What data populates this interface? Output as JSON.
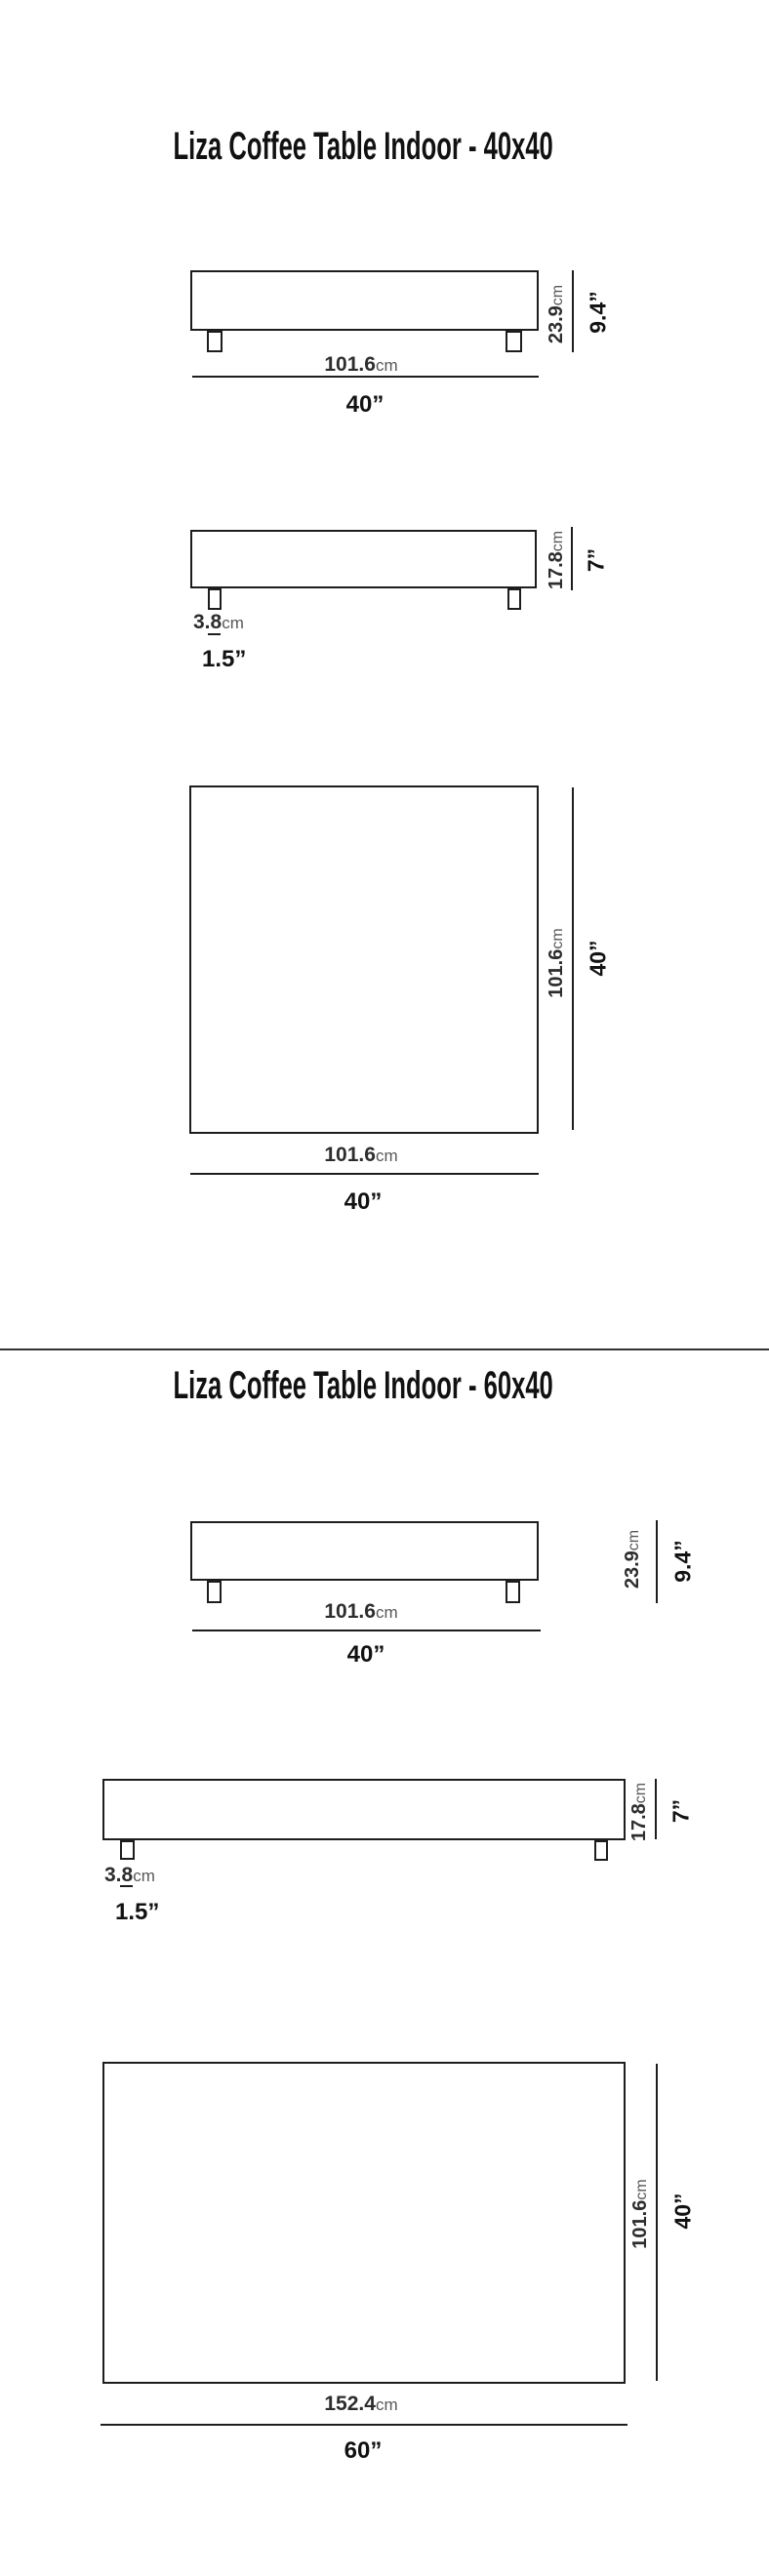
{
  "colors": {
    "background": "#ffffff",
    "line": "#1d1d1d",
    "number_text": "#2d2d2d",
    "cm_unit_text": "#575757",
    "inch_text": "#121212",
    "title_text": "#111111",
    "divider": "#333333"
  },
  "units": {
    "cm": "cm"
  },
  "sections": [
    {
      "title": "Liza Coffee Table Indoor - 40x40",
      "front_view": {
        "total_height_cm": "23.9",
        "total_height_in": "9.4”",
        "width_cm": "101.6",
        "width_in": "40”"
      },
      "profile_view": {
        "body_height_cm": "17.8",
        "body_height_in": "7”",
        "leg_width_cm": "3.8",
        "leg_width_in": "1.5”"
      },
      "top_view": {
        "depth_cm": "101.6",
        "depth_in": "40”",
        "width_cm": "101.6",
        "width_in": "40”"
      }
    },
    {
      "title": "Liza Coffee Table Indoor - 60x40",
      "front_view": {
        "total_height_cm": "23.9",
        "total_height_in": "9.4”",
        "width_cm": "101.6",
        "width_in": "40”"
      },
      "profile_view": {
        "body_height_cm": "17.8",
        "body_height_in": "7”",
        "leg_width_cm": "3.8",
        "leg_width_in": "1.5”"
      },
      "top_view": {
        "depth_cm": "101.6",
        "depth_in": "40”",
        "width_cm": "152.4",
        "width_in": "60”"
      }
    }
  ]
}
